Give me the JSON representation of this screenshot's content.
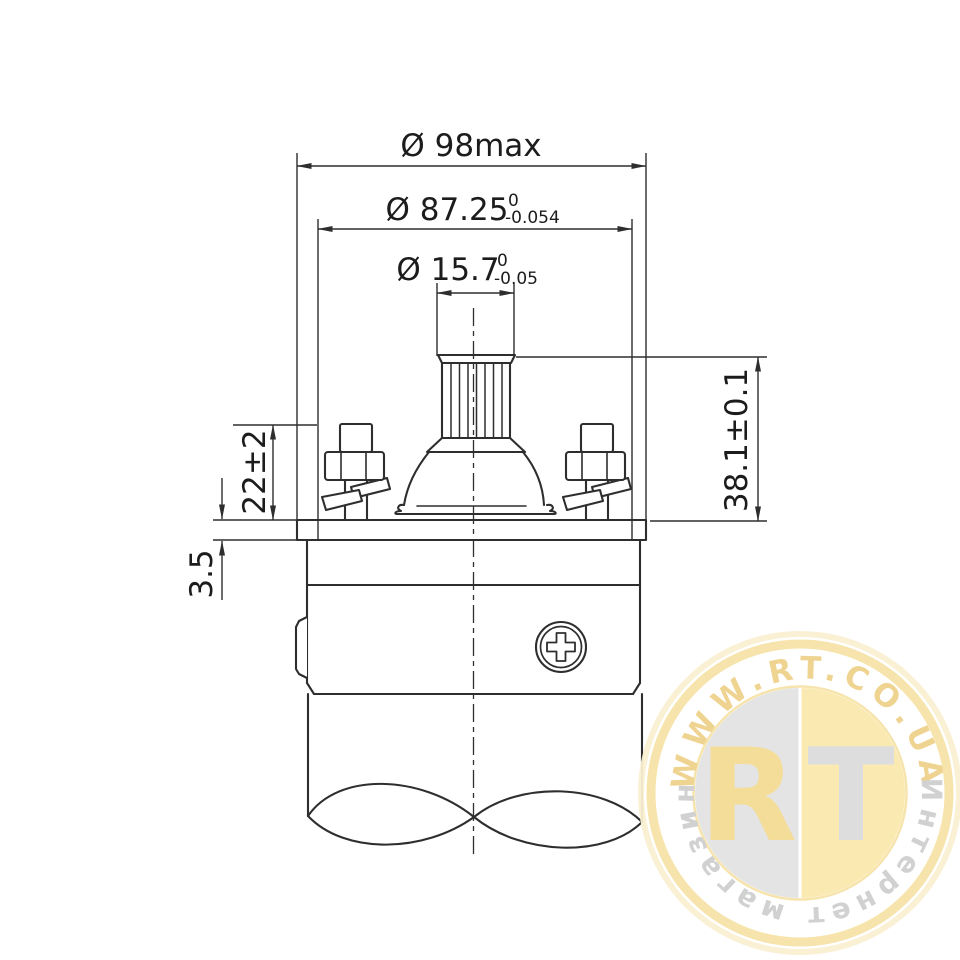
{
  "colors": {
    "line": "#2e2e2e",
    "text": "#1c1c1c",
    "wm_ring": "#f6e3a8",
    "wm_ring_outer": "#faf0d2",
    "wm_arc_text": "#efd18b",
    "wm_disc_gold": "#fae9ae",
    "wm_disc_gray": "#e3e3e3",
    "wm_letter_gold": "#f4dc94",
    "wm_letter_gray": "#dcdcdc",
    "wm_tagline": "#cfcfcf"
  },
  "dimensions": {
    "dia98": {
      "label": "Ø 98max"
    },
    "dia87": {
      "main": "Ø 87.25",
      "tol_top": "0",
      "tol_bottom": "-0.054"
    },
    "dia15": {
      "main": "Ø 15.7",
      "tol_top": "0",
      "tol_bottom": "-0.05"
    },
    "height38": {
      "label": "38.1±0.1"
    },
    "height22": {
      "label": "22±2"
    },
    "thickness35": {
      "label": "3.5"
    }
  },
  "watermark": {
    "site": "WWW.RT.CO.UA",
    "tagline": "Интернет магазин",
    "monogram_left": "R",
    "monogram_right": "T"
  }
}
